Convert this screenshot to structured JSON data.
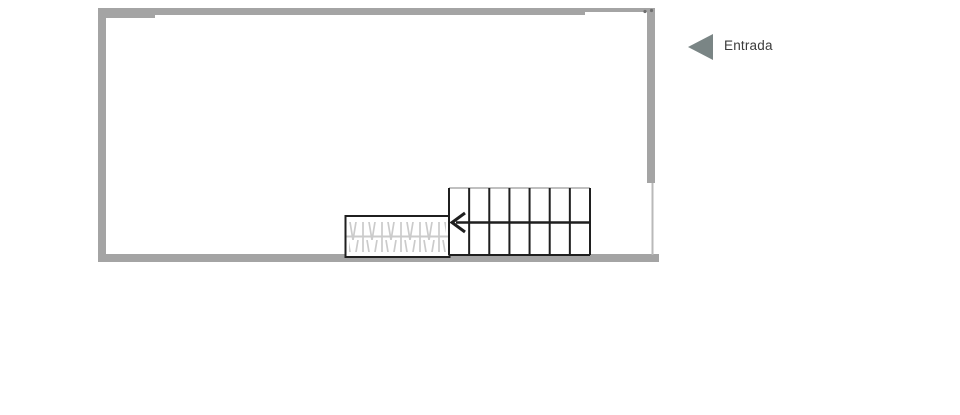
{
  "entrance": {
    "label": "Entrada",
    "marker_icon": "left-pointing-triangle-icon",
    "marker": {
      "tip_x": 688,
      "tip_y": 47,
      "base_x": 713,
      "top_y": 34,
      "bottom_y": 60
    }
  },
  "colors": {
    "background": "#ffffff",
    "wall": "#a4a4a4",
    "wall_light": "#b9b9b9",
    "line_dark": "#1f1f1f",
    "hatch": "#cbcbcb",
    "stair_top_edge": "#ababab",
    "marker": "#7a8585",
    "dot": "#6f6f6f",
    "text": "#3b3b3b"
  },
  "floorplan": {
    "canvas": {
      "width": 960,
      "height": 415
    },
    "walls": [
      {
        "name": "wall-top-left-thick",
        "x": 98,
        "y": 8,
        "w": 57,
        "h": 10
      },
      {
        "name": "wall-top-main",
        "x": 155,
        "y": 8,
        "w": 430,
        "h": 7
      },
      {
        "name": "wall-top-opening",
        "x": 585,
        "y": 8,
        "w": 62,
        "h": 4
      },
      {
        "name": "wall-right",
        "x": 647,
        "y": 8,
        "w": 8,
        "h": 175
      },
      {
        "name": "wall-left",
        "x": 98,
        "y": 8,
        "w": 8,
        "h": 254
      },
      {
        "name": "wall-bottom",
        "x": 98,
        "y": 254,
        "w": 561,
        "h": 8
      }
    ],
    "thin_wall_line": {
      "x": 652.5,
      "y1": 183,
      "y2": 255,
      "stroke_w": 2
    },
    "opening_dots": [
      {
        "x": 645.0,
        "y": 11.5,
        "r": 1.6
      },
      {
        "x": 651.5,
        "y": 10.5,
        "r": 1.6
      }
    ],
    "stairs": {
      "x": 449,
      "y": 188,
      "w": 141,
      "h": 67,
      "treads": 7,
      "arrow": {
        "y": 222.5,
        "tail_x": 589,
        "tip_x": 452,
        "chevron_dx": 13,
        "chevron_dy": 9.5
      }
    },
    "ramp": {
      "x": 345.5,
      "y": 216,
      "w": 104,
      "h": 41,
      "centerline_y": 236.5,
      "hatch_area": {
        "x": 349,
        "y": 222,
        "w": 97,
        "h": 30
      }
    }
  }
}
